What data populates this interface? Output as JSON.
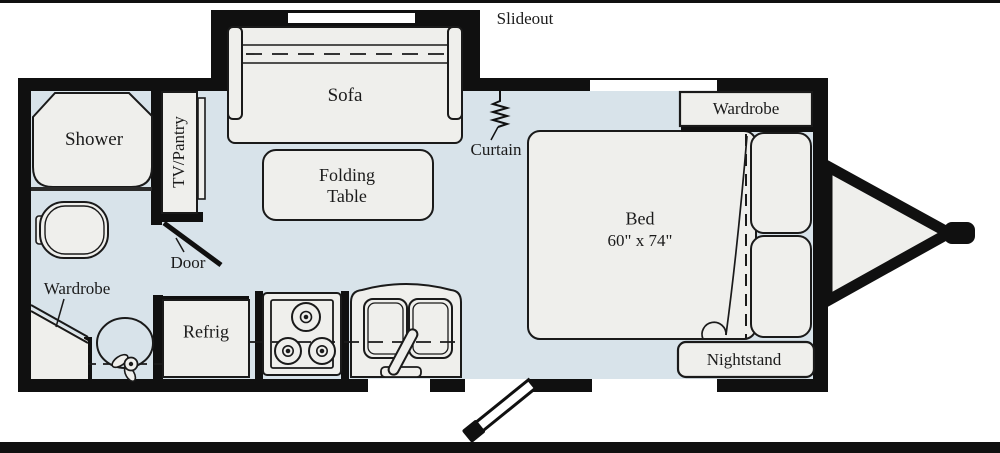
{
  "title": "Travel trailer floor plan",
  "colors": {
    "floor": "#d8e3ea",
    "wall": "#101010",
    "furniture_fill": "#efefec",
    "outline": "#1a1a1a",
    "window": "#ffffff",
    "background": "#ffffff"
  },
  "labels": {
    "slideout": "Slideout",
    "sofa": "Sofa",
    "shower": "Shower",
    "tv_pantry": "TV/Pantry",
    "folding_table": "Folding\nTable",
    "curtain": "Curtain",
    "wardrobe_bedroom": "Wardrobe",
    "bed": "Bed",
    "bed_size": "60\" x 74\"",
    "door": "Door",
    "wardrobe_bath": "Wardrobe",
    "refrig": "Refrig",
    "nightstand": "Nightstand"
  },
  "fixtures": [
    "slideout-sofa",
    "folding-table",
    "shower-stall",
    "toilet",
    "bathroom-sink",
    "corner-wardrobe",
    "bathroom-door",
    "tv-pantry-cabinet",
    "refrigerator",
    "three-burner-stove",
    "double-kitchen-sink",
    "entry-door",
    "curtain-divider",
    "bed",
    "bed-pillows",
    "bedroom-wardrobe",
    "nightstand",
    "trailer-hitch-tongue",
    "windows"
  ]
}
